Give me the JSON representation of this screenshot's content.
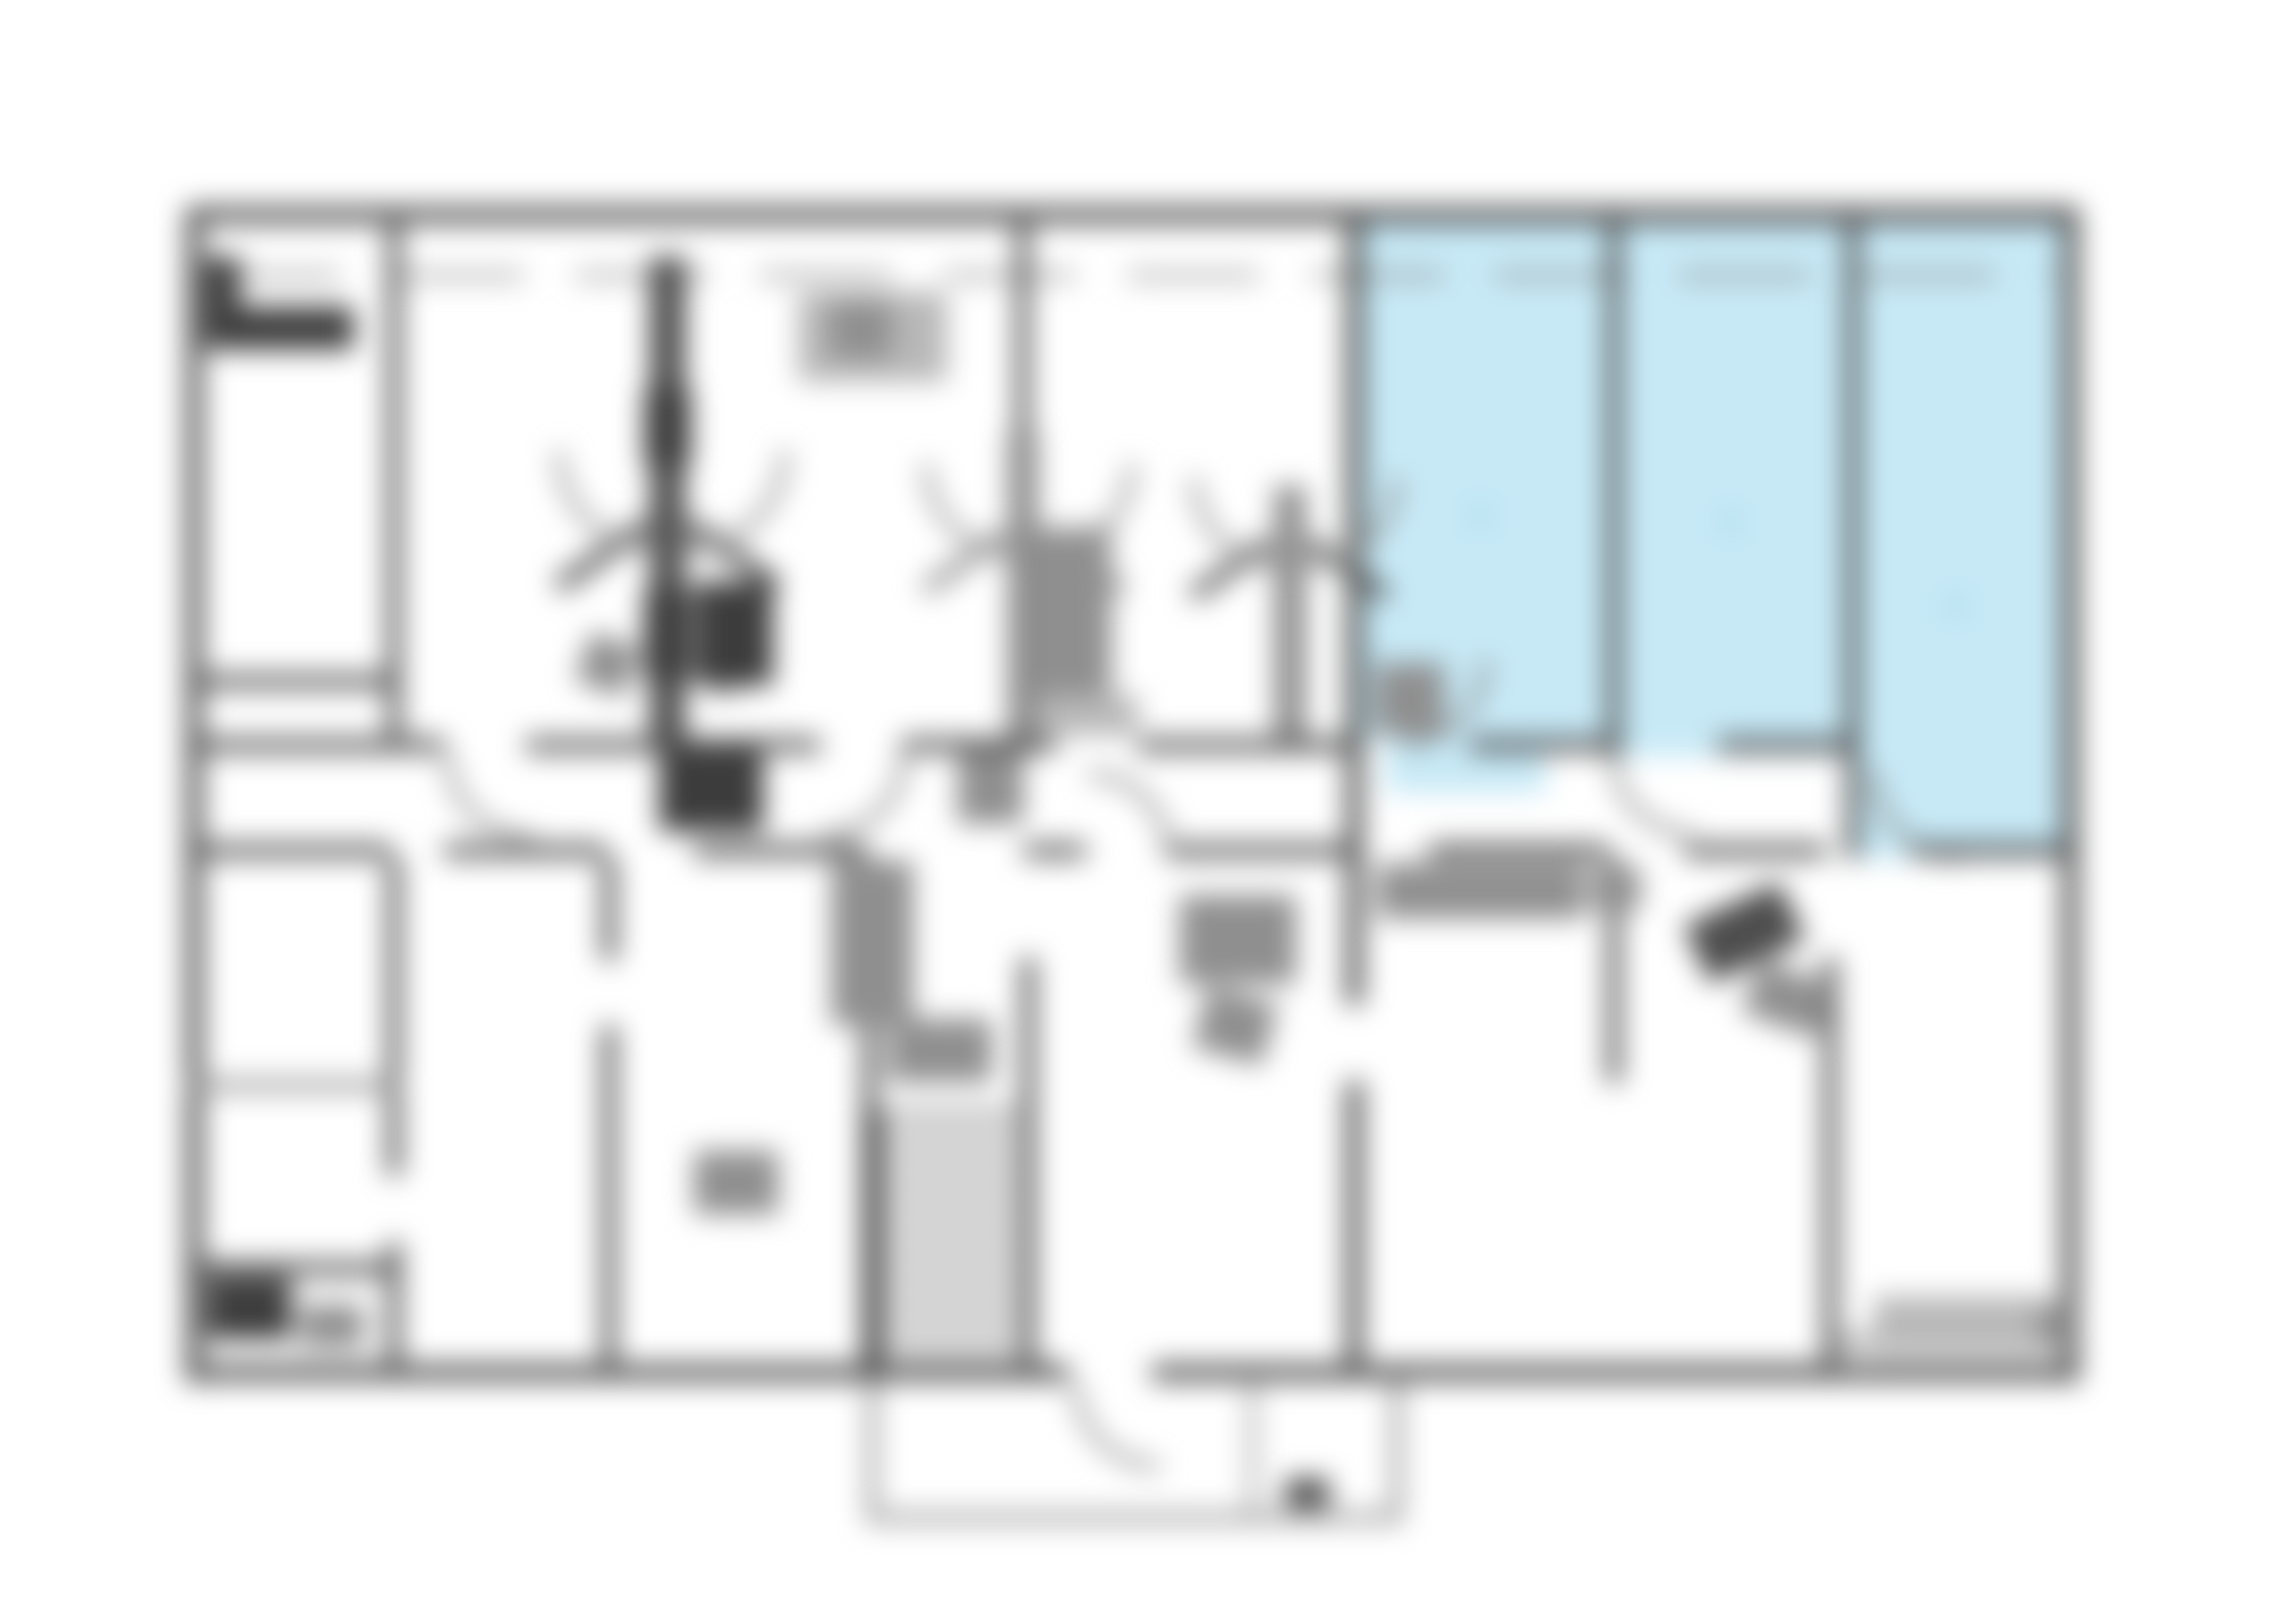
{
  "image": {
    "kind": "blurred-floor-plan",
    "orientation": "landscape",
    "highlighted_region": {
      "position": "top-right",
      "rooms_highlighted": 3,
      "fill": "#c7e9f6"
    }
  },
  "colors": {
    "background": "#ffffff",
    "wall": "#4d4d4d",
    "wall_light": "#8c8c8c",
    "wall_dark": "#3c3c3c",
    "furn": "#8f8f8f",
    "furn_light": "#b8b8b8",
    "highlight": "#c7e9f6",
    "highlight_dark": "#a9d8ea",
    "stripe": "#6e6e6e"
  }
}
